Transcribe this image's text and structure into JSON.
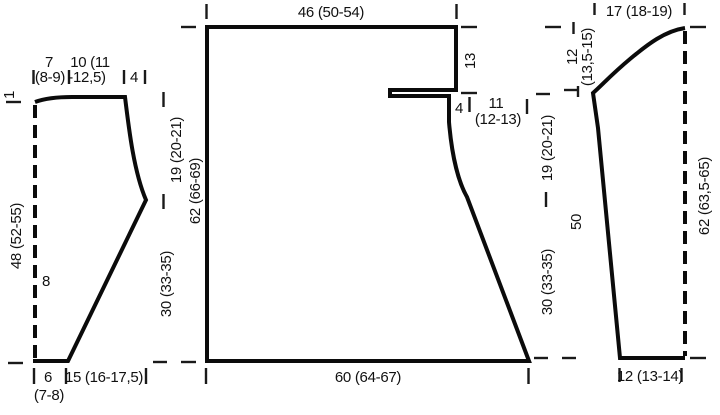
{
  "diagram": {
    "left_piece": {
      "top_rise": "1",
      "shoulder_w_line1": "7",
      "shoulder_w_line2": "(8-9)",
      "neck_w_line1": "10 (11",
      "neck_w_line2": "-12,5)",
      "top_w3": "4",
      "length_side": "48 (52-55)",
      "fold_mark": "8",
      "bottom_w1": "6",
      "bottom_w1_alt": "(7-8)",
      "bottom_w2": "15 (16-17,5)",
      "armhole_depth": "19 (20-21)",
      "side_seam": "30 (33-35)"
    },
    "body_piece": {
      "top_width": "46 (50-54)",
      "neck_drop": "13",
      "step_width": "4",
      "neck_w_line1": "11",
      "neck_w_line2": "(12-13)",
      "total_length": "62 (66-69)",
      "bottom_width": "60 (64-67)",
      "armhole_depth": "19 (20-21)",
      "side_seam": "30 (33-35)"
    },
    "sleeve_piece": {
      "top_width": "17 (18-19)",
      "cap_height_line1": "12",
      "cap_height_line2": "(13,5-15)",
      "seam_length": "50",
      "center_length": "62 (63,5-65)",
      "bottom_width": "12 (13-14)"
    },
    "colors": {
      "line": "#0b0b0b",
      "text": "#111111",
      "background": "#ffffff"
    }
  }
}
